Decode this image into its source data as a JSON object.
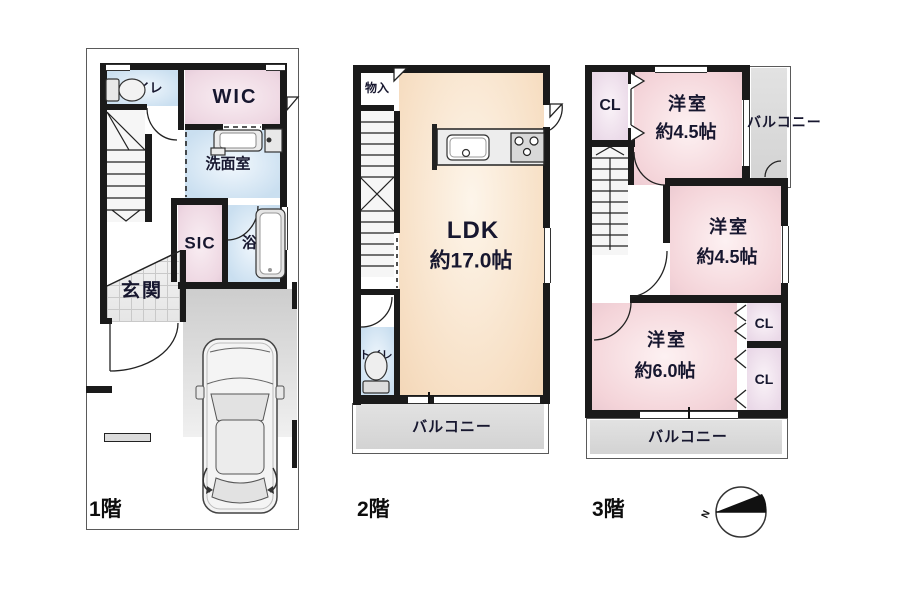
{
  "floors": {
    "f1": {
      "label": "1階",
      "toilet": "トイレ",
      "wic": "WIC",
      "washroom": "洗面室",
      "sic": "SIC",
      "bath": "浴室",
      "entrance": "玄関"
    },
    "f2": {
      "label": "2階",
      "storage": "物入",
      "ldk_name": "LDK",
      "ldk_size": "約17.0帖",
      "toilet": "トイレ",
      "balcony": "バルコニー"
    },
    "f3": {
      "label": "3階",
      "closet_top": "CL",
      "room1_name": "洋室",
      "room1_size": "約4.5帖",
      "balcony_side": "バルコニー",
      "room2_name": "洋室",
      "room2_size": "約4.5帖",
      "closet_mid": "CL",
      "closet_low": "CL",
      "room3_name": "洋室",
      "room3_size": "約6.0帖",
      "balcony_bottom": "バルコニー"
    }
  },
  "compass": {
    "north_label": "N"
  },
  "colors": {
    "wall": "#1a1a1a",
    "room_pink": "#f4d4d9",
    "room_blue": "#cadff0",
    "room_peach": "#f7dfc4",
    "room_lavender": "#ead9e8",
    "balcony_gray": "#d9d9d9",
    "text": "#17172f"
  }
}
